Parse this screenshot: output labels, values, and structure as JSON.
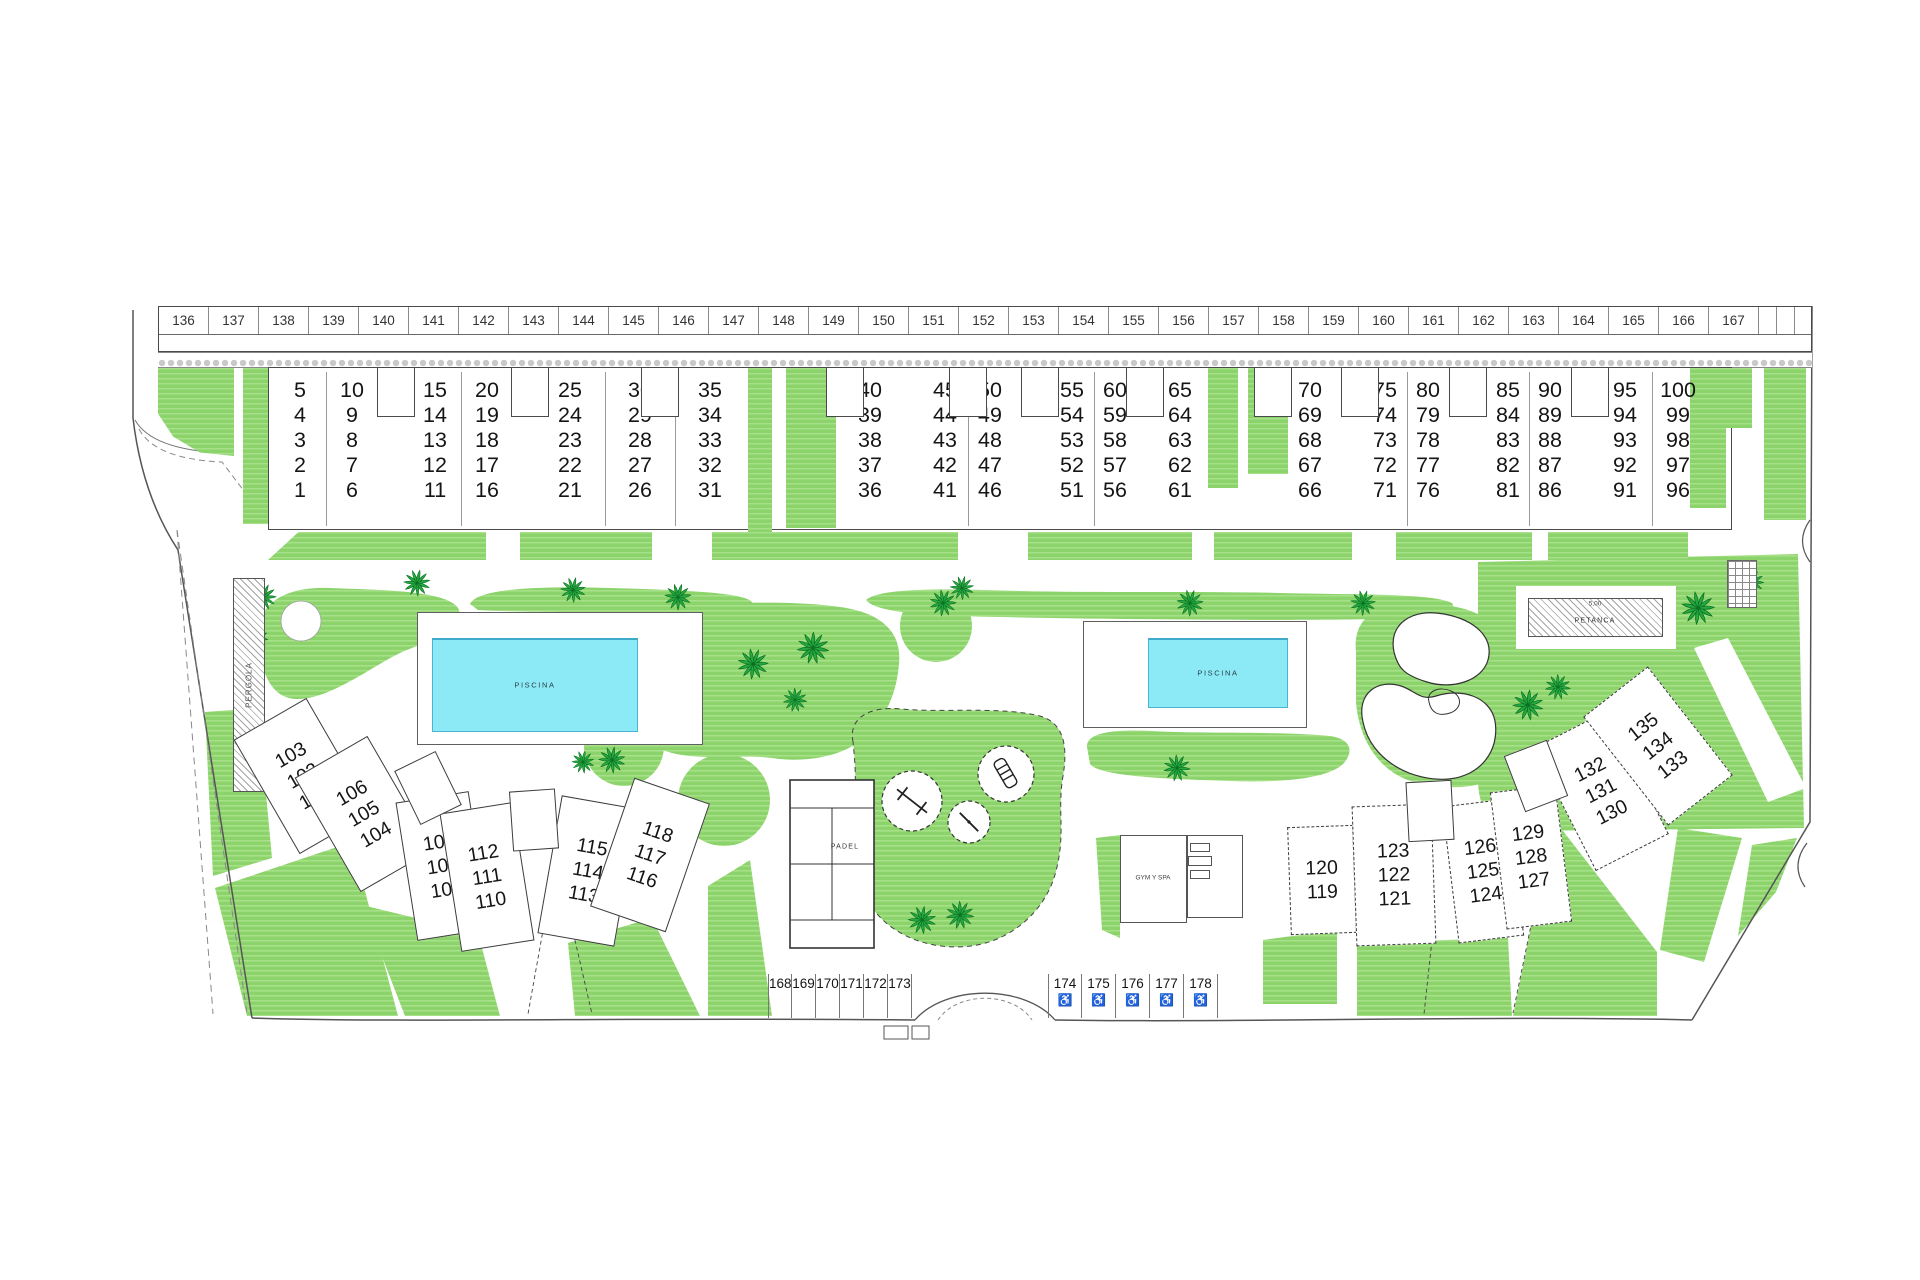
{
  "title": "Residential site plan",
  "colors": {
    "grass": "#8bd36a",
    "grass_stripe": "#a6e189",
    "palm": "#25a93f",
    "palm_dark": "#0b6e23",
    "pool_water": "#8beaf5",
    "outline": "#4a4a4a"
  },
  "amenities": {
    "pool": "PISCINA",
    "pergola": "PERGOLA",
    "petanca": "PETANCA",
    "petanca_dim": "5,00",
    "padel": "PADEL",
    "gym": "GYM Y SPA"
  },
  "parking_top": {
    "slots": [
      "136",
      "137",
      "138",
      "139",
      "140",
      "141",
      "142",
      "143",
      "144",
      "145",
      "146",
      "147",
      "148",
      "149",
      "150",
      "151",
      "152",
      "153",
      "154",
      "155",
      "156",
      "157",
      "158",
      "159",
      "160",
      "161",
      "162",
      "163",
      "164",
      "165",
      "166",
      "167"
    ],
    "narrow_slot_count": 3
  },
  "units": {
    "columns": [
      {
        "x": 300,
        "labels": [
          "5",
          "4",
          "3",
          "2",
          "1"
        ]
      },
      {
        "x": 352,
        "labels": [
          "10",
          "9",
          "8",
          "7",
          "6"
        ]
      },
      {
        "x": 435,
        "labels": [
          "15",
          "14",
          "13",
          "12",
          "11"
        ]
      },
      {
        "x": 487,
        "labels": [
          "20",
          "19",
          "18",
          "17",
          "16"
        ]
      },
      {
        "x": 570,
        "labels": [
          "25",
          "24",
          "23",
          "22",
          "21"
        ]
      },
      {
        "x": 640,
        "labels": [
          "30",
          "29",
          "28",
          "27",
          "26"
        ]
      },
      {
        "x": 710,
        "labels": [
          "35",
          "34",
          "33",
          "32",
          "31"
        ]
      },
      {
        "x": 870,
        "labels": [
          "40",
          "39",
          "38",
          "37",
          "36"
        ]
      },
      {
        "x": 945,
        "labels": [
          "45",
          "44",
          "43",
          "42",
          "41"
        ]
      },
      {
        "x": 990,
        "labels": [
          "50",
          "49",
          "48",
          "47",
          "46"
        ]
      },
      {
        "x": 1072,
        "labels": [
          "55",
          "54",
          "53",
          "52",
          "51"
        ]
      },
      {
        "x": 1115,
        "labels": [
          "60",
          "59",
          "58",
          "57",
          "56"
        ]
      },
      {
        "x": 1180,
        "labels": [
          "65",
          "64",
          "63",
          "62",
          "61"
        ]
      },
      {
        "x": 1310,
        "labels": [
          "70",
          "69",
          "68",
          "67",
          "66"
        ]
      },
      {
        "x": 1385,
        "labels": [
          "75",
          "74",
          "73",
          "72",
          "71"
        ]
      },
      {
        "x": 1428,
        "labels": [
          "80",
          "79",
          "78",
          "77",
          "76"
        ]
      },
      {
        "x": 1508,
        "labels": [
          "85",
          "84",
          "83",
          "82",
          "81"
        ]
      },
      {
        "x": 1550,
        "labels": [
          "90",
          "89",
          "88",
          "87",
          "86"
        ]
      },
      {
        "x": 1625,
        "labels": [
          "95",
          "94",
          "93",
          "92",
          "91"
        ]
      },
      {
        "x": 1678,
        "labels": [
          "100",
          "99",
          "98",
          "97",
          "96"
        ]
      }
    ],
    "dividers": [
      326,
      461,
      605,
      675,
      968,
      1094,
      1407,
      1529,
      1652
    ],
    "stair_boxes": [
      396,
      530,
      660,
      845,
      968,
      1040,
      1145,
      1273,
      1360,
      1468,
      1590
    ]
  },
  "clusters": {
    "left": [
      {
        "x": 303,
        "y": 776,
        "w": 84,
        "h": 132,
        "rot": -30,
        "labels": [
          "103",
          "102",
          "101"
        ]
      },
      {
        "x": 364,
        "y": 814,
        "w": 84,
        "h": 132,
        "rot": -30,
        "labels": [
          "106",
          "105",
          "104"
        ]
      },
      {
        "x": 443,
        "y": 866,
        "w": 74,
        "h": 140,
        "rot": -9,
        "labels": [
          "109",
          "108",
          "107"
        ]
      },
      {
        "x": 487,
        "y": 877,
        "w": 74,
        "h": 140,
        "rot": -9,
        "labels": [
          "112",
          "111",
          "110"
        ]
      },
      {
        "x": 588,
        "y": 871,
        "w": 78,
        "h": 140,
        "rot": 10,
        "labels": [
          "115",
          "114",
          "113"
        ]
      },
      {
        "x": 650,
        "y": 855,
        "w": 80,
        "h": 136,
        "rot": 19,
        "labels": [
          "118",
          "117",
          "116"
        ]
      }
    ],
    "right": [
      {
        "x": 1322,
        "y": 880,
        "w": 66,
        "h": 108,
        "rot": -2,
        "labels": [
          "120",
          "119"
        ]
      },
      {
        "x": 1394,
        "y": 875,
        "w": 80,
        "h": 140,
        "rot": -2,
        "labels": [
          "123",
          "122",
          "121"
        ]
      },
      {
        "x": 1483,
        "y": 871,
        "w": 66,
        "h": 138,
        "rot": -7,
        "labels": [
          "126",
          "125",
          "124"
        ]
      },
      {
        "x": 1531,
        "y": 857,
        "w": 66,
        "h": 138,
        "rot": -7,
        "labels": [
          "129",
          "128",
          "127"
        ]
      },
      {
        "x": 1601,
        "y": 791,
        "w": 82,
        "h": 138,
        "rot": -27,
        "labels": [
          "132",
          "131",
          "130"
        ]
      },
      {
        "x": 1658,
        "y": 746,
        "w": 82,
        "h": 138,
        "rot": -38,
        "labels": [
          "135",
          "134",
          "133"
        ]
      }
    ],
    "stairs": [
      {
        "x": 428,
        "y": 788,
        "rot": -26
      },
      {
        "x": 534,
        "y": 820,
        "rot": -4
      },
      {
        "x": 1430,
        "y": 811,
        "rot": -3
      },
      {
        "x": 1536,
        "y": 776,
        "rot": -21
      }
    ]
  },
  "parking_bottom": {
    "left_slots": [
      "168",
      "169",
      "170",
      "171",
      "172",
      "173"
    ],
    "right_slots": [
      "174",
      "175",
      "176",
      "177",
      "178"
    ],
    "accessible_icon": "♿"
  },
  "palms": [
    [
      263,
      597,
      1
    ],
    [
      256,
      638,
      0.9
    ],
    [
      417,
      583,
      1
    ],
    [
      573,
      590,
      0.95
    ],
    [
      678,
      597,
      1
    ],
    [
      962,
      588,
      0.9
    ],
    [
      753,
      664,
      1.15
    ],
    [
      813,
      648,
      1.2
    ],
    [
      795,
      700,
      0.9
    ],
    [
      612,
      760,
      1
    ],
    [
      583,
      762,
      0.85
    ],
    [
      943,
      603,
      1
    ],
    [
      1190,
      603,
      1
    ],
    [
      1363,
      603,
      0.95
    ],
    [
      1177,
      768,
      1
    ],
    [
      922,
      920,
      1.05
    ],
    [
      960,
      915,
      1.05
    ],
    [
      1528,
      705,
      1.15
    ],
    [
      1558,
      687,
      0.95
    ],
    [
      1698,
      608,
      1.25
    ],
    [
      1752,
      582,
      0.9
    ]
  ]
}
